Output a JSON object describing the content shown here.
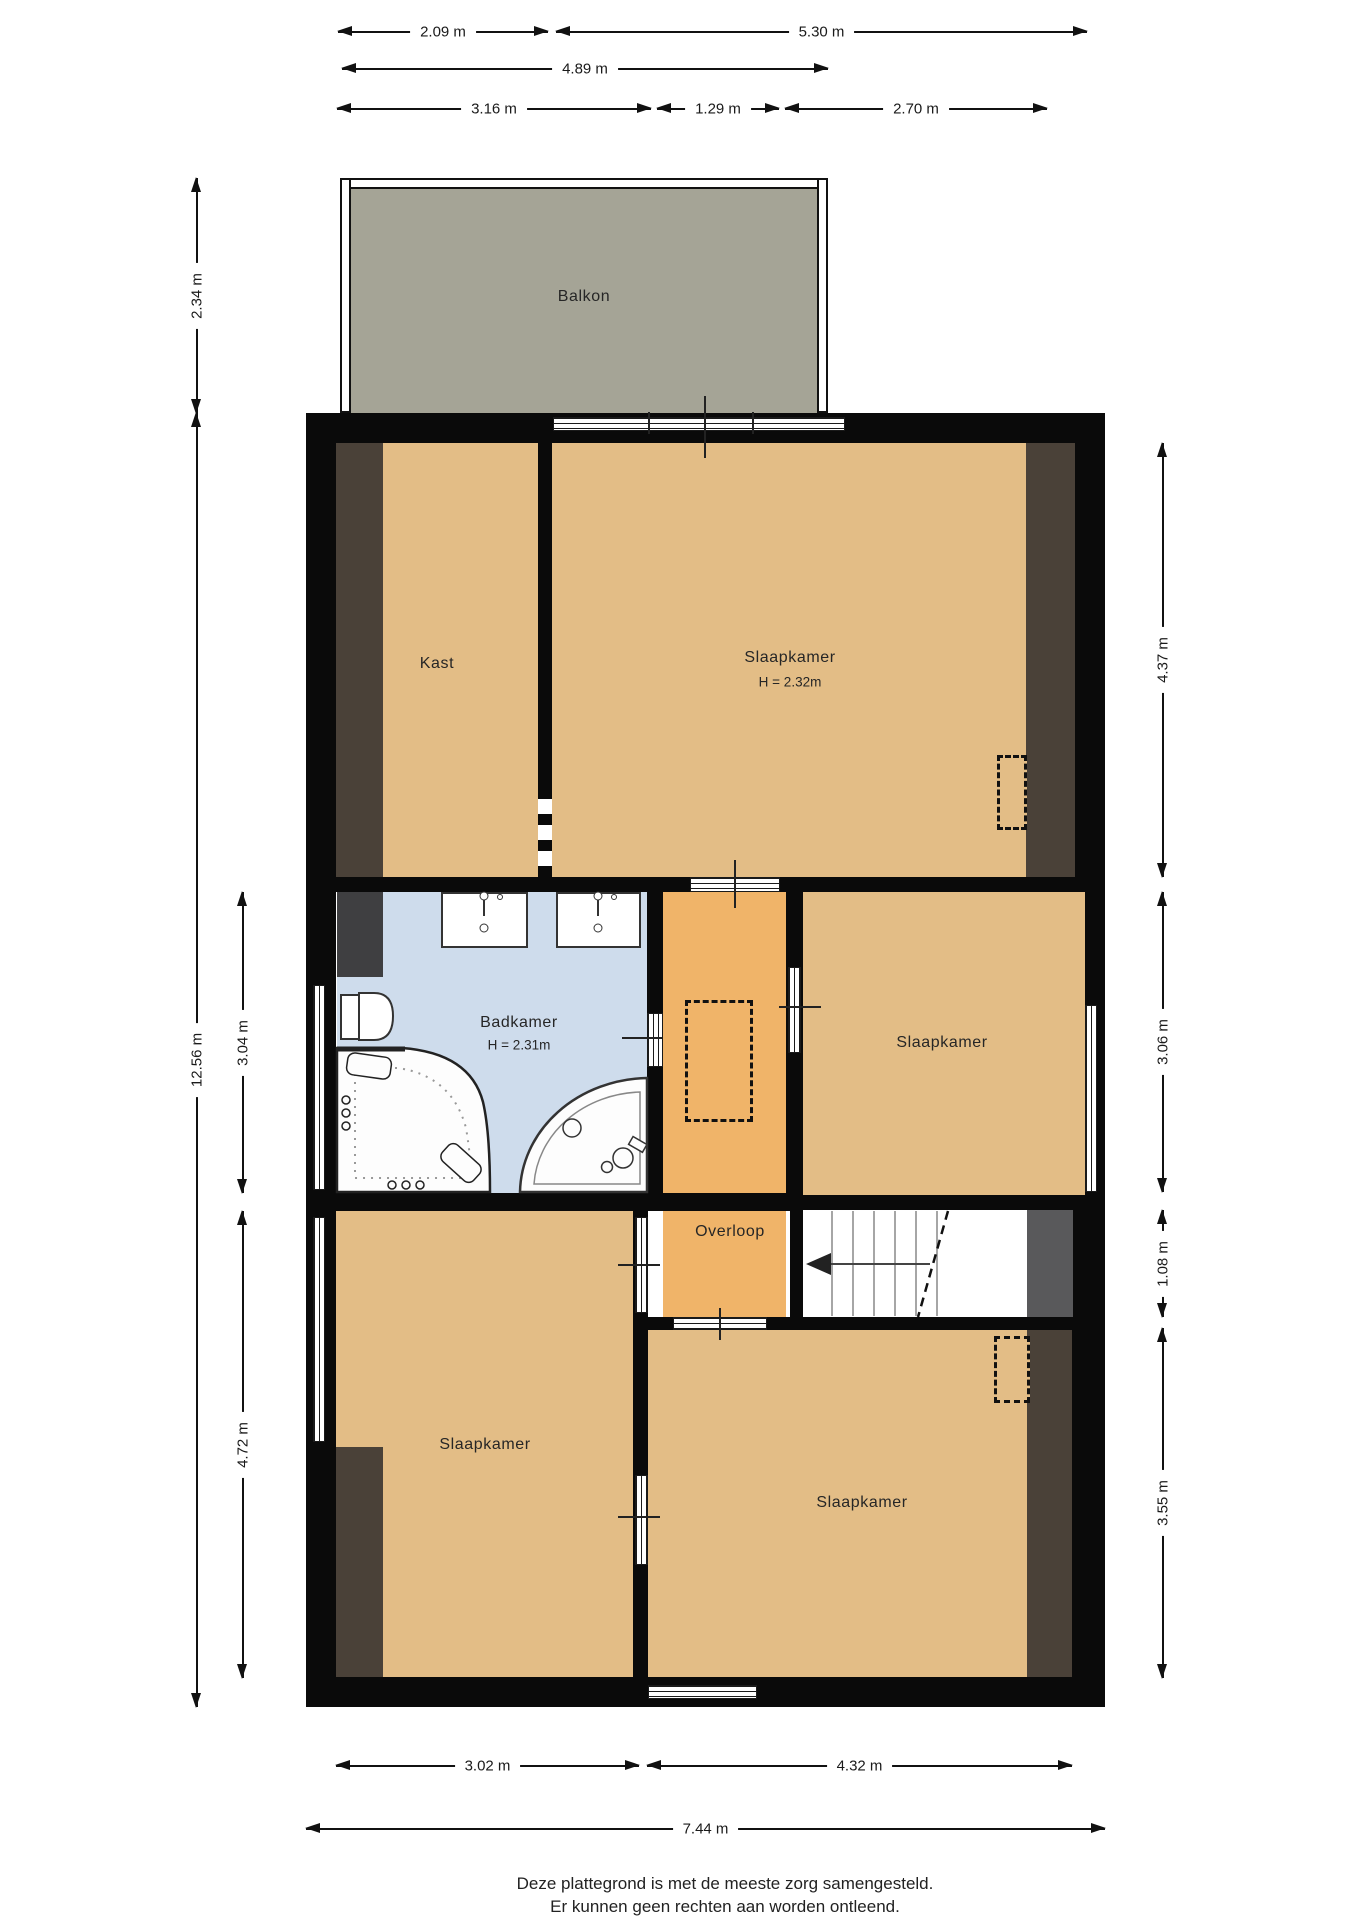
{
  "plan_title": "Plattegrond verdieping",
  "rooms": {
    "balkon": {
      "label": "Balkon"
    },
    "kast": {
      "label": "Kast"
    },
    "slaapkamer_boven": {
      "label": "Slaapkamer",
      "ceiling_height": "H = 2.32m"
    },
    "badkamer": {
      "label": "Badkamer",
      "ceiling_height": "H = 2.31m"
    },
    "slaapkamer_midden": {
      "label": "Slaapkamer"
    },
    "overloop": {
      "label": "Overloop"
    },
    "slaapkamer_linksonder": {
      "label": "Slaapkamer"
    },
    "slaapkamer_rechtsonder": {
      "label": "Slaapkamer"
    }
  },
  "dimensions": {
    "top": [
      {
        "value": "2.09 m"
      },
      {
        "value": "5.30 m"
      },
      {
        "value": "4.89 m"
      },
      {
        "value": "3.16 m"
      },
      {
        "value": "1.29 m"
      },
      {
        "value": "2.70 m"
      }
    ],
    "left": [
      {
        "value": "2.34 m"
      },
      {
        "value": "12.56 m"
      },
      {
        "value": "3.04 m"
      },
      {
        "value": "4.72 m"
      }
    ],
    "right": [
      {
        "value": "4.37 m"
      },
      {
        "value": "3.06 m"
      },
      {
        "value": "1.08 m"
      },
      {
        "value": "3.55 m"
      }
    ],
    "bottom": [
      {
        "value": "3.02 m"
      },
      {
        "value": "4.32 m"
      },
      {
        "value": "7.44 m"
      }
    ]
  },
  "footer": {
    "line1": "Deze plattegrond is met de meeste zorg samengesteld.",
    "line2": "Er kunnen geen rechten aan worden ontleend."
  },
  "colors": {
    "wall": "#0a0a0a",
    "floor_tan": "#e3bd86",
    "overloop_orange": "#f0b469",
    "bathroom_blue": "#cedcec",
    "balcony_gray": "#a5a496",
    "knee_wall_brown": "#4a4138",
    "block_dark_gray": "#3f3f41",
    "block_mid_gray": "#59595b"
  }
}
